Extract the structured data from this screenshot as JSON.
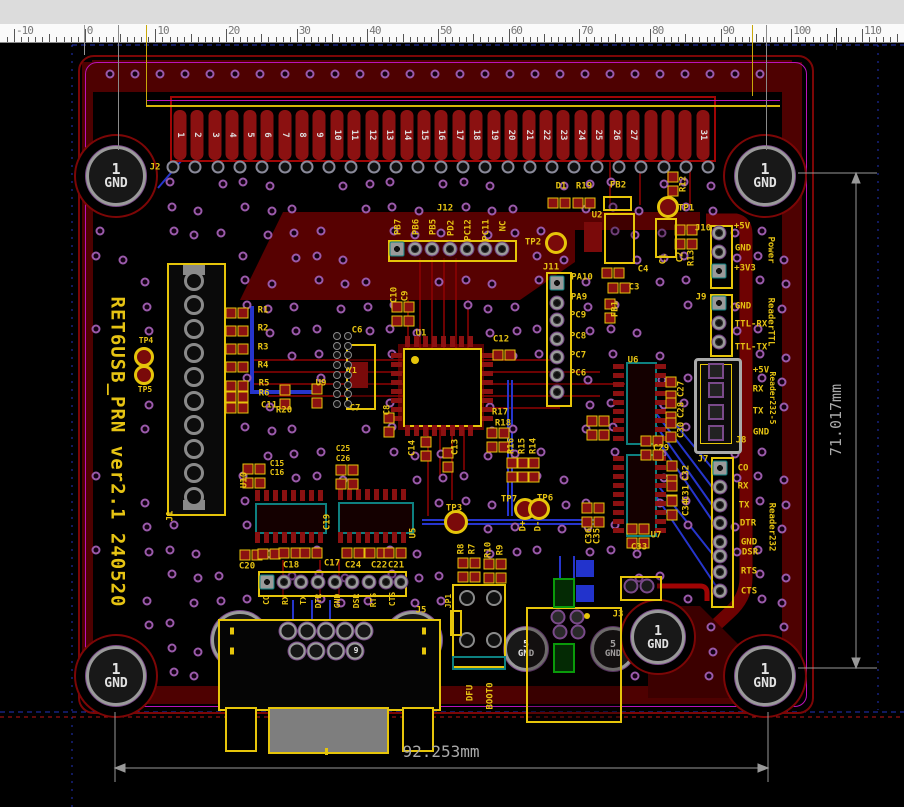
{
  "window": {
    "type": "pcb-cad-viewer"
  },
  "ruler": {
    "unit_numbers": [
      -10,
      0,
      10,
      20,
      30,
      40,
      50,
      60,
      70,
      80,
      90,
      100,
      110
    ],
    "origin_x": 84.7,
    "px_per_unit": 7.066
  },
  "board": {
    "title_silkscreen": "RET6USB_PRN ver2.1 240520"
  },
  "dimensions": {
    "vertical": "71.017mm",
    "horizontal": "92.253mm"
  },
  "j2": {
    "ref": "J2",
    "pins": [
      "1",
      "2",
      "3",
      "4",
      "5",
      "6",
      "7",
      "8",
      "9",
      "10",
      "11",
      "12",
      "13",
      "14",
      "15",
      "16",
      "17",
      "18",
      "19",
      "20",
      "21",
      "22",
      "23",
      "24",
      "25",
      "26",
      "27",
      "",
      "",
      "",
      "31"
    ]
  },
  "holes": [
    {
      "x": 116,
      "y": 176,
      "r": 27,
      "ko": 40,
      "n": "1",
      "l": "GND",
      "fs": [
        15,
        13
      ]
    },
    {
      "x": 765,
      "y": 176,
      "r": 27,
      "ko": 40,
      "n": "1",
      "l": "GND",
      "fs": [
        15,
        13
      ]
    },
    {
      "x": 116,
      "y": 676,
      "r": 27,
      "ko": 40,
      "n": "1",
      "l": "GND",
      "fs": [
        15,
        13
      ]
    },
    {
      "x": 765,
      "y": 676,
      "r": 27,
      "ko": 40,
      "n": "1",
      "l": "GND",
      "fs": [
        15,
        13
      ]
    },
    {
      "x": 240,
      "y": 640,
      "r": 26,
      "ko": 0,
      "n": "11",
      "l": "GND",
      "fs": [
        14,
        13
      ]
    },
    {
      "x": 413,
      "y": 640,
      "r": 26,
      "ko": 0,
      "n": "10",
      "l": "GND",
      "fs": [
        14,
        13
      ]
    },
    {
      "x": 526,
      "y": 649,
      "r": 19,
      "ko": 0,
      "n": "5",
      "l": "GND",
      "fs": [
        10,
        9
      ]
    },
    {
      "x": 613,
      "y": 649,
      "r": 19,
      "ko": 0,
      "n": "5",
      "l": "GND",
      "fs": [
        10,
        9
      ]
    },
    {
      "x": 658,
      "y": 637,
      "r": 24,
      "ko": 36,
      "n": "1",
      "l": "GND",
      "fs": [
        13,
        12
      ]
    }
  ],
  "labels": [
    {
      "t": "J2",
      "x": 155,
      "y": 168
    },
    {
      "t": "D1",
      "x": 561,
      "y": 187
    },
    {
      "t": "R19",
      "x": 584,
      "y": 187
    },
    {
      "t": "FB2",
      "x": 618,
      "y": 186
    },
    {
      "t": "R12",
      "x": 684,
      "y": 184,
      "r": -90
    },
    {
      "t": "U2",
      "x": 597,
      "y": 216
    },
    {
      "t": "TP1",
      "x": 686,
      "y": 209
    },
    {
      "t": "C1",
      "x": 664,
      "y": 259,
      "r": -90
    },
    {
      "t": "C2",
      "x": 681,
      "y": 257,
      "r": -90
    },
    {
      "t": "R13",
      "x": 692,
      "y": 258,
      "r": -90
    },
    {
      "t": "C4",
      "x": 643,
      "y": 270
    },
    {
      "t": "C3",
      "x": 634,
      "y": 288
    },
    {
      "t": "FB1",
      "x": 616,
      "y": 309,
      "r": -90
    },
    {
      "t": "J12",
      "x": 445,
      "y": 209
    },
    {
      "t": "PB7",
      "x": 399,
      "y": 227,
      "r": -90
    },
    {
      "t": "PB6",
      "x": 417,
      "y": 227,
      "r": -90
    },
    {
      "t": "PB5",
      "x": 434,
      "y": 227,
      "r": -90
    },
    {
      "t": "PD2",
      "x": 452,
      "y": 228,
      "r": -90
    },
    {
      "t": "PC12",
      "x": 469,
      "y": 230,
      "r": -90
    },
    {
      "t": "PC11",
      "x": 487,
      "y": 230,
      "r": -90
    },
    {
      "t": "NC",
      "x": 504,
      "y": 226,
      "r": -90
    },
    {
      "t": "TP2",
      "x": 533,
      "y": 243
    },
    {
      "t": "J11",
      "x": 551,
      "y": 268
    },
    {
      "t": "PA10",
      "x": 582,
      "y": 278
    },
    {
      "t": "PA9",
      "x": 579,
      "y": 298
    },
    {
      "t": "PC9",
      "x": 578,
      "y": 316
    },
    {
      "t": "PC8",
      "x": 578,
      "y": 337
    },
    {
      "t": "PC7",
      "x": 578,
      "y": 356
    },
    {
      "t": "PC6",
      "x": 578,
      "y": 374
    },
    {
      "t": "J10",
      "x": 703,
      "y": 229
    },
    {
      "t": "+5V",
      "x": 742,
      "y": 227
    },
    {
      "t": "GND",
      "x": 743,
      "y": 249
    },
    {
      "t": "+3V3",
      "x": 745,
      "y": 269
    },
    {
      "t": "Power",
      "x": 770,
      "y": 250,
      "r": 90
    },
    {
      "t": "J9",
      "x": 701,
      "y": 298
    },
    {
      "t": "GND",
      "x": 743,
      "y": 307
    },
    {
      "t": "TTL-RX",
      "x": 751,
      "y": 325
    },
    {
      "t": "TTL-TX",
      "x": 751,
      "y": 348
    },
    {
      "t": "ReaderTTL",
      "x": 770,
      "y": 322,
      "r": 90
    },
    {
      "t": "+5V",
      "x": 761,
      "y": 371
    },
    {
      "t": "RX",
      "x": 758,
      "y": 390
    },
    {
      "t": "TX",
      "x": 758,
      "y": 412
    },
    {
      "t": "GND",
      "x": 761,
      "y": 433
    },
    {
      "t": "Reader232-5",
      "x": 772,
      "y": 398,
      "r": 90,
      "s": 8
    },
    {
      "t": "J8",
      "x": 741,
      "y": 441
    },
    {
      "t": "J7",
      "x": 703,
      "y": 460
    },
    {
      "t": "CO",
      "x": 743,
      "y": 469
    },
    {
      "t": "RX",
      "x": 743,
      "y": 487
    },
    {
      "t": "TX",
      "x": 744,
      "y": 506
    },
    {
      "t": "DTR",
      "x": 748,
      "y": 524
    },
    {
      "t": "GND",
      "x": 749,
      "y": 543
    },
    {
      "t": "DSR",
      "x": 750,
      "y": 553
    },
    {
      "t": "RTS",
      "x": 749,
      "y": 572
    },
    {
      "t": "CTS",
      "x": 749,
      "y": 592
    },
    {
      "t": "Reader232",
      "x": 771,
      "y": 527,
      "r": 90
    },
    {
      "t": "TP4",
      "x": 146,
      "y": 341,
      "s": 8
    },
    {
      "t": "TP5",
      "x": 145,
      "y": 390,
      "s": 8
    },
    {
      "t": "R1",
      "x": 263,
      "y": 311
    },
    {
      "t": "R2",
      "x": 263,
      "y": 329
    },
    {
      "t": "R3",
      "x": 263,
      "y": 348
    },
    {
      "t": "R4",
      "x": 263,
      "y": 366
    },
    {
      "t": "R5",
      "x": 264,
      "y": 384
    },
    {
      "t": "R6",
      "x": 264,
      "y": 394
    },
    {
      "t": "C11",
      "x": 269,
      "y": 406
    },
    {
      "t": "R20",
      "x": 284,
      "y": 411
    },
    {
      "t": "U9",
      "x": 321,
      "y": 384
    },
    {
      "t": "C6",
      "x": 357,
      "y": 331
    },
    {
      "t": "C7",
      "x": 355,
      "y": 409
    },
    {
      "t": "Y1",
      "x": 352,
      "y": 371,
      "s": 8
    },
    {
      "t": "C10",
      "x": 395,
      "y": 295,
      "r": -90
    },
    {
      "t": "C9",
      "x": 406,
      "y": 296,
      "r": -90
    },
    {
      "t": "C8",
      "x": 388,
      "y": 410,
      "r": -90
    },
    {
      "t": "U1",
      "x": 421,
      "y": 334
    },
    {
      "t": "C12",
      "x": 501,
      "y": 340
    },
    {
      "t": "R17",
      "x": 500,
      "y": 413
    },
    {
      "t": "R18",
      "x": 503,
      "y": 424
    },
    {
      "t": "C13",
      "x": 456,
      "y": 447,
      "r": -90
    },
    {
      "t": "R16",
      "x": 512,
      "y": 446,
      "r": -90
    },
    {
      "t": "R15",
      "x": 523,
      "y": 446,
      "r": -90
    },
    {
      "t": "R14",
      "x": 534,
      "y": 446,
      "r": -90
    },
    {
      "t": "TP3",
      "x": 454,
      "y": 509
    },
    {
      "t": "TP7",
      "x": 509,
      "y": 500
    },
    {
      "t": "TP6",
      "x": 545,
      "y": 499
    },
    {
      "t": "D+",
      "x": 524,
      "y": 526,
      "r": -90
    },
    {
      "t": "D-",
      "x": 539,
      "y": 526,
      "r": -90
    },
    {
      "t": "R8",
      "x": 462,
      "y": 549,
      "r": -90
    },
    {
      "t": "R7",
      "x": 473,
      "y": 549,
      "r": -90
    },
    {
      "t": "R10",
      "x": 489,
      "y": 550,
      "r": -90
    },
    {
      "t": "R9",
      "x": 501,
      "y": 550,
      "r": -90
    },
    {
      "t": "C25",
      "x": 343,
      "y": 449,
      "s": 8
    },
    {
      "t": "C26",
      "x": 343,
      "y": 459,
      "s": 8
    },
    {
      "t": "C15",
      "x": 277,
      "y": 464,
      "s": 8
    },
    {
      "t": "C16",
      "x": 277,
      "y": 473,
      "s": 8
    },
    {
      "t": "C14",
      "x": 413,
      "y": 448,
      "r": -90
    },
    {
      "t": "U10",
      "x": 245,
      "y": 480,
      "r": -90
    },
    {
      "t": "C19",
      "x": 328,
      "y": 522,
      "r": -90
    },
    {
      "t": "U5",
      "x": 414,
      "y": 533,
      "r": -90
    },
    {
      "t": "C20",
      "x": 247,
      "y": 567
    },
    {
      "t": "C18",
      "x": 291,
      "y": 566
    },
    {
      "t": "C17",
      "x": 332,
      "y": 564
    },
    {
      "t": "C24",
      "x": 353,
      "y": 566
    },
    {
      "t": "C22",
      "x": 379,
      "y": 566
    },
    {
      "t": "C21",
      "x": 396,
      "y": 566
    },
    {
      "t": "U6",
      "x": 633,
      "y": 361
    },
    {
      "t": "C27",
      "x": 682,
      "y": 389,
      "r": -90
    },
    {
      "t": "C28",
      "x": 682,
      "y": 410,
      "r": -90
    },
    {
      "t": "C30",
      "x": 682,
      "y": 430,
      "r": -90
    },
    {
      "t": "C29",
      "x": 661,
      "y": 449
    },
    {
      "t": "C32",
      "x": 687,
      "y": 473,
      "r": -90
    },
    {
      "t": "C31",
      "x": 687,
      "y": 493,
      "r": -90
    },
    {
      "t": "C34",
      "x": 687,
      "y": 508,
      "r": -90
    },
    {
      "t": "C33",
      "x": 639,
      "y": 548
    },
    {
      "t": "U7",
      "x": 656,
      "y": 536
    },
    {
      "t": "C35",
      "x": 598,
      "y": 536,
      "r": -90
    },
    {
      "t": "C36",
      "x": 590,
      "y": 536,
      "r": -90
    },
    {
      "t": "CO",
      "x": 267,
      "y": 600,
      "r": -90,
      "s": 8
    },
    {
      "t": "RX",
      "x": 286,
      "y": 600,
      "r": -90,
      "s": 8
    },
    {
      "t": "TX",
      "x": 304,
      "y": 600,
      "r": -90,
      "s": 8
    },
    {
      "t": "DTR",
      "x": 319,
      "y": 601,
      "r": -90,
      "s": 8
    },
    {
      "t": "GND",
      "x": 338,
      "y": 601,
      "r": -90,
      "s": 8
    },
    {
      "t": "DSR",
      "x": 357,
      "y": 601,
      "r": -90,
      "s": 8
    },
    {
      "t": "RTS",
      "x": 374,
      "y": 600,
      "r": -90,
      "s": 8
    },
    {
      "t": "CTS",
      "x": 393,
      "y": 599,
      "r": -90,
      "s": 8
    },
    {
      "t": "J5",
      "x": 421,
      "y": 611
    },
    {
      "t": "JP1",
      "x": 449,
      "y": 601,
      "r": -90,
      "s": 8
    },
    {
      "t": "DFU",
      "x": 471,
      "y": 693,
      "r": -90
    },
    {
      "t": "BOOT0",
      "x": 491,
      "y": 696,
      "r": -90
    },
    {
      "t": "J3",
      "x": 618,
      "y": 615
    },
    {
      "t": "J1",
      "x": 171,
      "y": 516,
      "r": -90
    },
    {
      "t": "9",
      "x": 356,
      "y": 651,
      "c": "w",
      "s": 8
    }
  ],
  "colors": {
    "silk": "#e6c313",
    "via": "#9a5aaa",
    "pour": "#560101",
    "trace_top": "#8f0303",
    "trace_bottom": "#2635cc",
    "dim": "#a0a0a0",
    "board_edge": "#7c0606",
    "magenta": "#bb12bb",
    "pad": "#8b1111",
    "hole_ring": "#9a9a9a"
  }
}
